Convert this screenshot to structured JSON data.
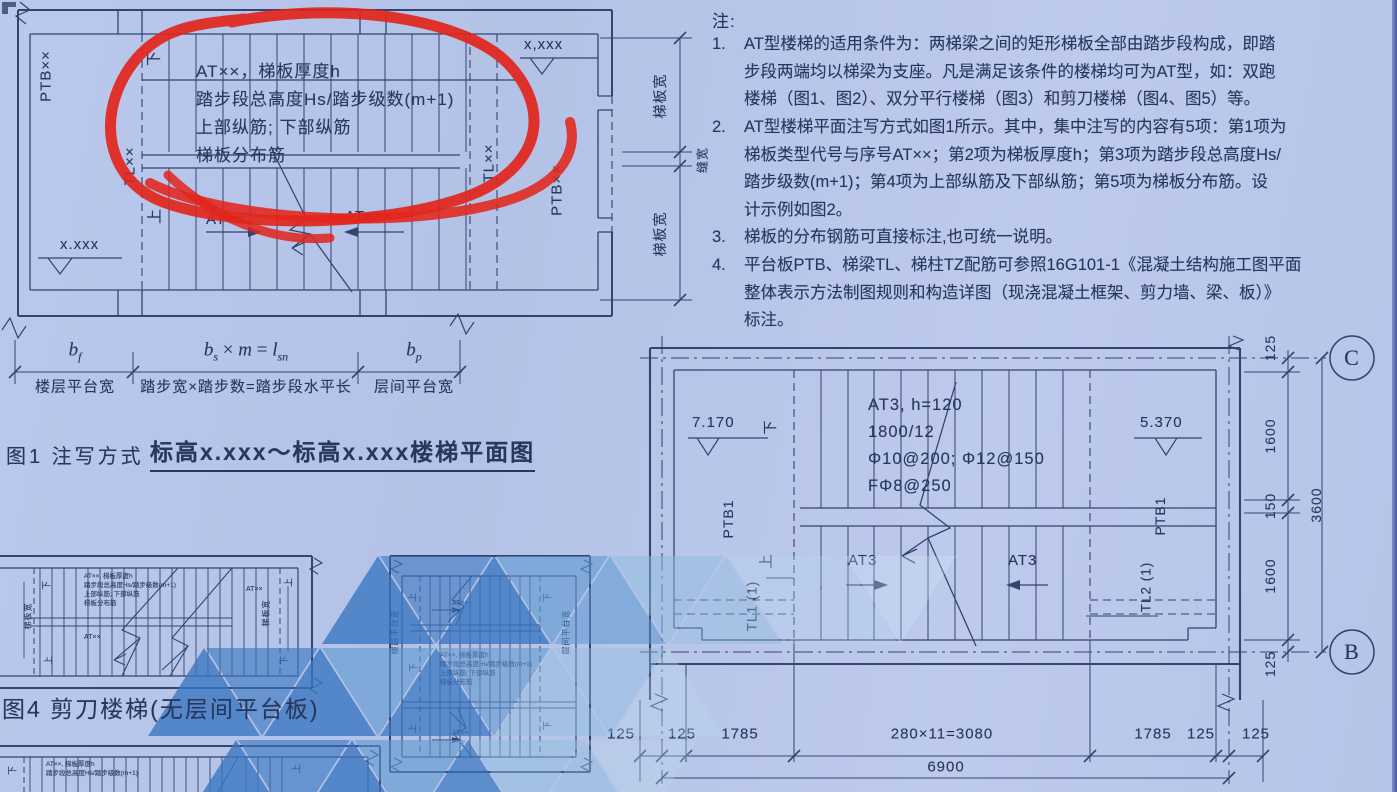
{
  "colors": {
    "paper": "#b6c4e8",
    "ink": "#33446e",
    "text": "#27375e",
    "red": "#e2251c",
    "wm_dark": "#3876c2",
    "wm_mid": "#5b97d0",
    "wm_light": "#8fbce2",
    "wm_faint": "#b9d6ec"
  },
  "fig1": {
    "caption_prefix": "图1 注写方式",
    "caption_title": "标高x.xxx～标高x.xxx楼梯平面图",
    "annotation": {
      "line1": "AT××，梯板厚度h",
      "line2": "踏步段总高度Hs/踏步级数(m+1)",
      "line3": "上部纵筋; 下部纵筋",
      "line4": "梯板分布筋"
    },
    "labels": {
      "ptb_left": "PTB××",
      "ptb_right": "PTB××",
      "tl_left": "TL××",
      "tl_right": "TL××",
      "down": "下",
      "up": "上",
      "at_left": "AT××",
      "at_right": "AT××",
      "elev_bottom": "x.xxx",
      "elev_top": "x,xxx",
      "dim_top": "梯板宽",
      "dim_gap": "缝宽",
      "dim_bottom": "梯板宽"
    },
    "dims": {
      "bf": {
        "b": "b",
        "f": "f"
      },
      "bf_label": "楼层平台宽",
      "bs": {
        "b": "b",
        "s": "s",
        "times": "×",
        "m": "m",
        "eq": "=",
        "l": "l",
        "sn": "sn"
      },
      "bs_label": "踏步宽×踏步数=踏步段水平长",
      "bp": {
        "b": "b",
        "p": "p"
      },
      "bp_label": "层间平台宽"
    }
  },
  "notes": {
    "title": "注:",
    "items": [
      {
        "no": "1.",
        "lines": [
          "AT型楼梯的适用条件为：两梯梁之间的矩形梯板全部由踏步段构成，即踏",
          "步段两端均以梯梁为支座。凡是满足该条件的楼梯均可为AT型，如：双跑",
          "楼梯（图1、图2）、双分平行楼梯（图3）和剪刀楼梯（图4、图5）等。"
        ]
      },
      {
        "no": "2.",
        "lines": [
          "AT型楼梯平面注写方式如图1所示。其中，集中注写的内容有5项：第1项为",
          "梯板类型代号与序号AT××；第2项为梯板厚度h；第3项为踏步段总高度Hs/",
          "踏步级数(m+1)；第4项为上部纵筋及下部纵筋；第5项为梯板分布筋。设",
          "计示例如图2。"
        ]
      },
      {
        "no": "3.",
        "lines": [
          "梯板的分布钢筋可直接标注,也可统一说明。"
        ]
      },
      {
        "no": "4.",
        "lines": [
          "平台板PTB、梯梁TL、梯柱TZ配筋可参照16G101-1《混凝土结构施工图平面",
          "整体表示方法制图规则和构造详图（现浇混凝土框架、剪力墙、梁、板）》",
          "标注。"
        ]
      }
    ]
  },
  "fig2": {
    "annotation": {
      "line1": "AT3, h=120",
      "line2": "1800/12",
      "line3": "Φ10@200; Φ12@150",
      "line4": "FΦ8@250"
    },
    "labels": {
      "elev_left": "7.170",
      "elev_right": "5.370",
      "down": "下",
      "up": "上",
      "ptb_left": "PTB1",
      "ptb_right": "PTB1",
      "tl_left": "TL1 (1)",
      "tl_right": "TL2 (1)",
      "at_left": "AT3",
      "at_right": "AT3"
    },
    "dims_bottom": [
      "125",
      "125",
      "1785",
      "280×11=3080",
      "1785",
      "125",
      "125"
    ],
    "dim_total_bottom": "6900",
    "dims_right": [
      "125",
      "1600",
      "150",
      "1600",
      "125"
    ],
    "dim_total_right": "3600",
    "axis_top": "C",
    "axis_bottom": "B"
  },
  "fig4": {
    "caption": "图4 剪刀楼梯(无层间平台板)",
    "annotation": {
      "line1": "AT××, 梯板厚度h",
      "line2": "踏步段总高度Hs/踏步级数(m+1)",
      "line3": "上部纵筋; 下部纵筋",
      "line4": "梯板分布筋"
    },
    "labels": {
      "at1": "AT××",
      "at2": "AT××",
      "down_tl": "下",
      "up_tr": "上",
      "up_bl": "上",
      "down_br": "下",
      "side_left": "梯板宽",
      "side_right": "梯板宽"
    }
  },
  "fig3": {
    "annotation": {
      "line1": "AT××, 梯板厚度h",
      "line2": "踏步段总高度Hs/踏步级数(m+1)",
      "line3": "上部纵筋; 下部纵筋",
      "line4": "梯板分布筋"
    },
    "labels": {
      "up_tl": "上",
      "down_tr": "下",
      "down_ml": "下",
      "up_bl": "上",
      "down_br": "下",
      "at_top": "AT××",
      "at_bottom": "AT××",
      "side_left": "楼层平台宽",
      "side_right": "层间平台宽"
    }
  },
  "fig5": {
    "annotation": {
      "line1": "AT××, 梯板厚度h",
      "line2": "踏步段总高度Hs/踏步级数(m+1)"
    },
    "labels": {
      "down": "下",
      "up": "上"
    }
  }
}
